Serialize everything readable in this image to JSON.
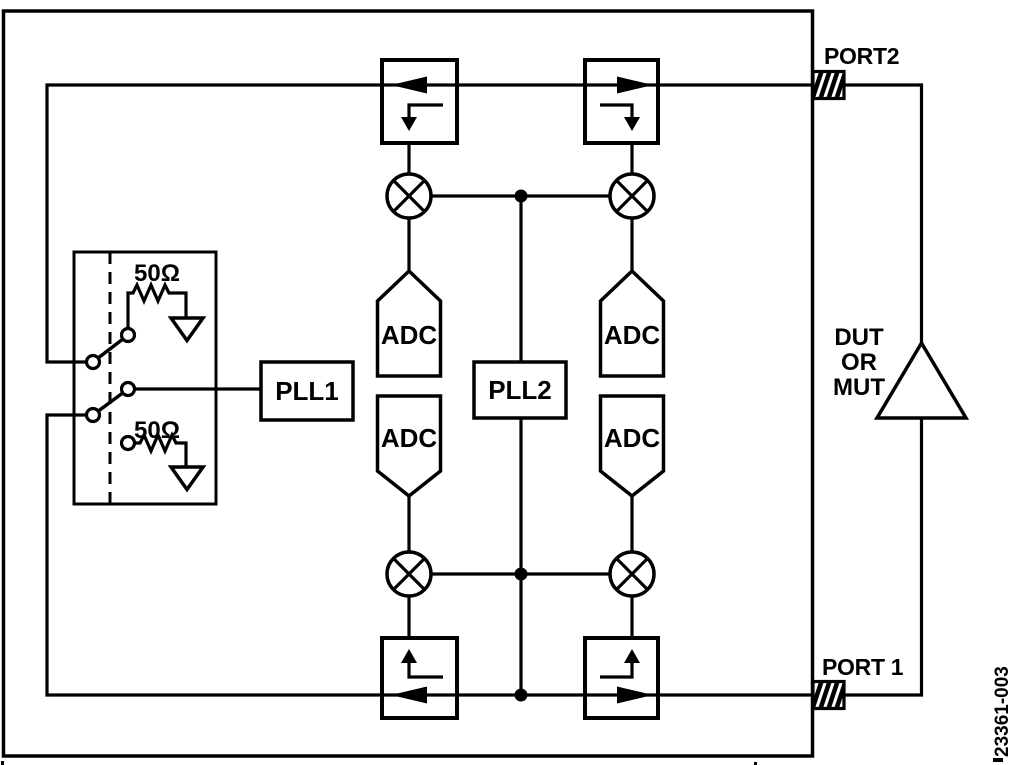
{
  "figure": {
    "code": "23361-003",
    "background": "#ffffff",
    "ink": "#000000"
  },
  "ports": {
    "port2": "PORT2",
    "port1": "PORT 1"
  },
  "device_under_test": {
    "line1": "DUT",
    "line2": "OR",
    "line3": "MUT"
  },
  "synthesizers": {
    "pll1": "PLL1",
    "pll2": "PLL2"
  },
  "adcs": [
    "ADC",
    "ADC",
    "ADC",
    "ADC"
  ],
  "terminations": {
    "top": "50Ω",
    "bottom": "50Ω"
  }
}
